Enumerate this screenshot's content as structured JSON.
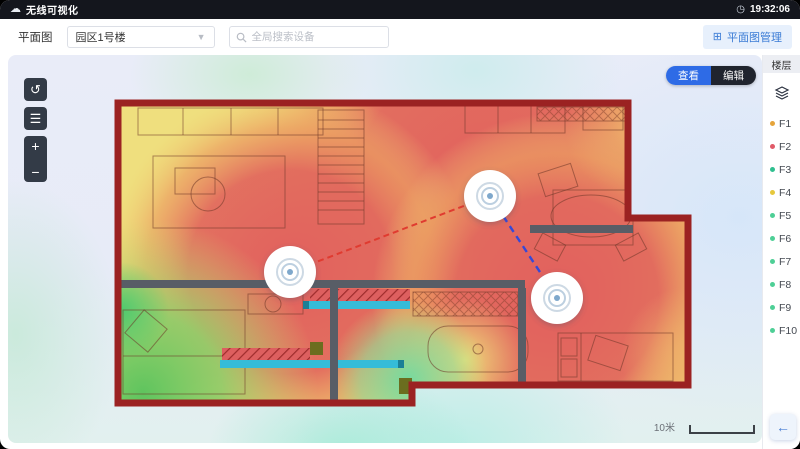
{
  "topbar": {
    "title": "无线可视化",
    "time": "19:32:06"
  },
  "toolbar": {
    "page_label": "平面图",
    "building_selector_value": "园区1号楼",
    "search_placeholder": "全局搜索设备",
    "manage_button": "平面图管理"
  },
  "canvas": {
    "view_toggle": {
      "view": "查看",
      "edit": "编辑"
    },
    "scale_label": "10米",
    "zoom_in": "+",
    "zoom_out": "−"
  },
  "sidebar": {
    "header": "楼层",
    "floors": [
      {
        "label": "F1",
        "color": "#e5a43b"
      },
      {
        "label": "F2",
        "color": "#e05a68"
      },
      {
        "label": "F3",
        "color": "#2fbf8f"
      },
      {
        "label": "F4",
        "color": "#e6c83c"
      },
      {
        "label": "F5",
        "color": "#4ecf96"
      },
      {
        "label": "F6",
        "color": "#4ecf96"
      },
      {
        "label": "F7",
        "color": "#4ecf96"
      },
      {
        "label": "F8",
        "color": "#4ecf96"
      },
      {
        "label": "F9",
        "color": "#4ecf96"
      },
      {
        "label": "F10",
        "color": "#4ecf96"
      }
    ]
  },
  "icons": {
    "topbar_left": "cloud-icon",
    "topbar_right": "clock-icon",
    "toolbar": [
      "chevron-down-icon",
      "search-icon",
      "floorplan-manage-icon"
    ],
    "canvas_tools": [
      "undo-icon",
      "list-icon",
      "zoom-in-icon",
      "zoom-out-icon"
    ],
    "sidebar": "layers-icon",
    "bottom_right": "arrow-left-icon",
    "map_markers": "wireless-ap-icon"
  },
  "colors": {
    "accent_blue": "#2e6be6",
    "topbar_bg": "#14161d",
    "wall_outline": "#9b2222",
    "heat_strong": "#e2625f",
    "heat_mid": "#eeb36e",
    "heat_weak": "#efdf7e",
    "heat_low": "#6ec85a",
    "link_red": "#e03b30",
    "link_blue": "#3548d8"
  }
}
